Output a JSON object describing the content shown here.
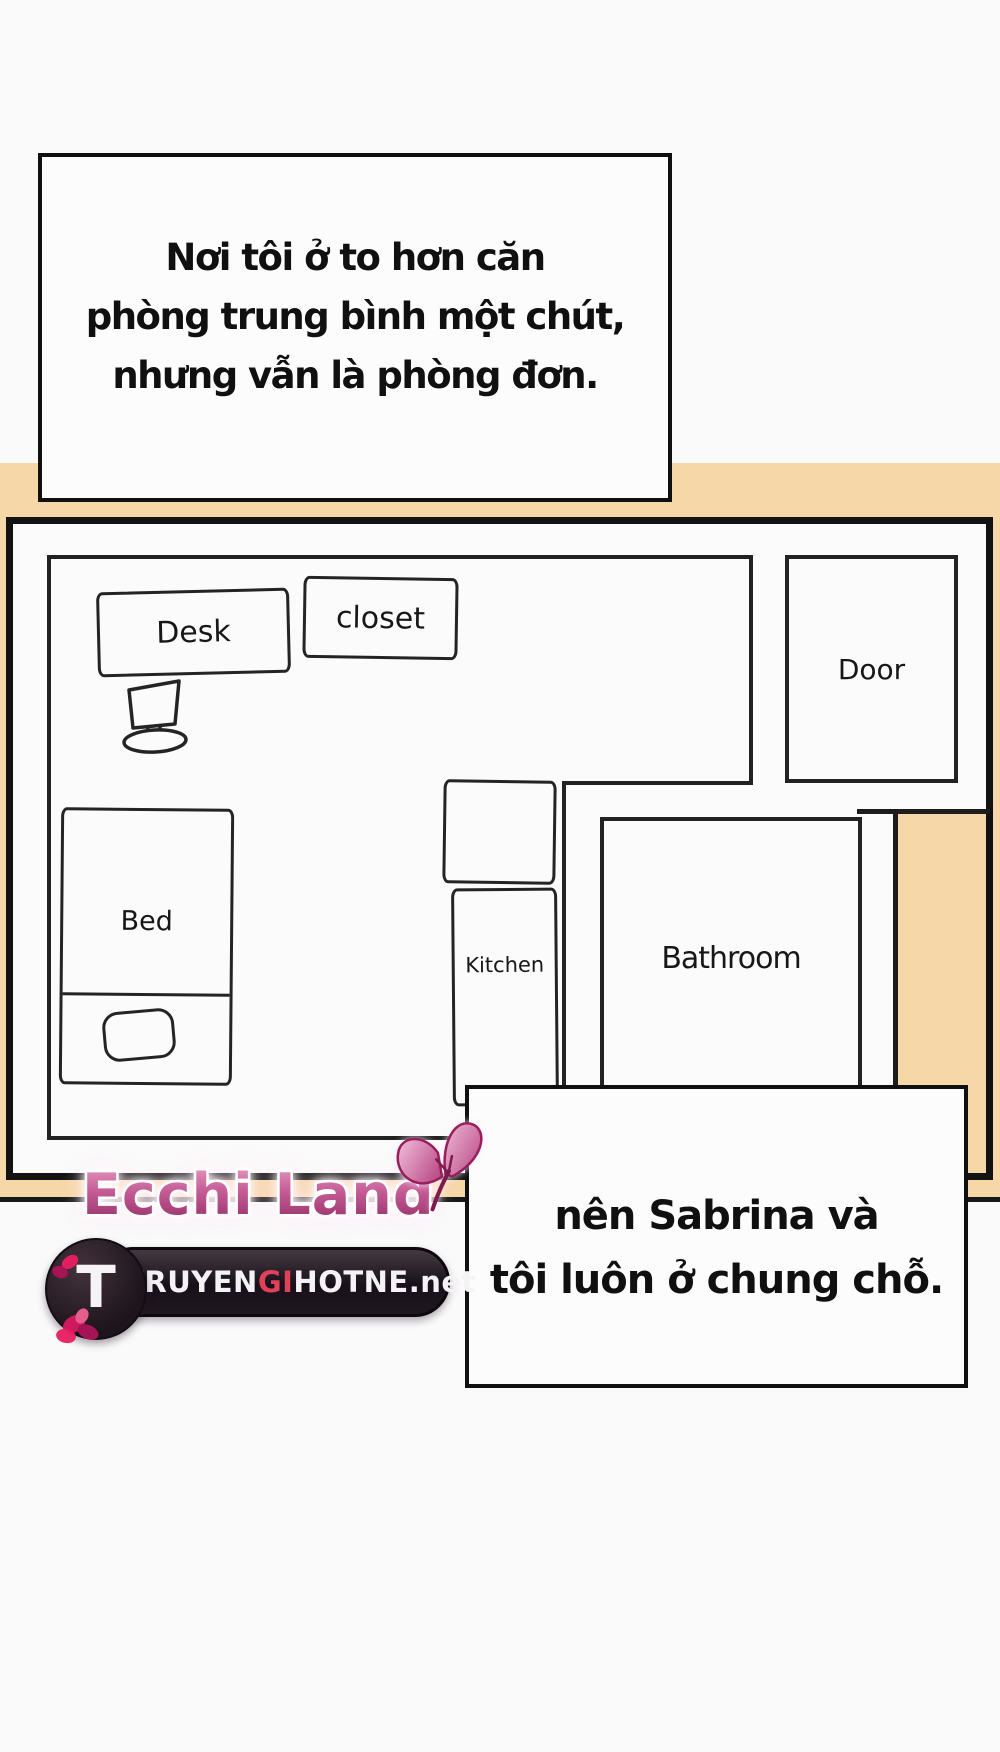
{
  "page": {
    "background_color": "#fafafa",
    "ink_color": "#1a1a1a",
    "peach_color": "#f6d7a7"
  },
  "speech_box_1": {
    "lines": [
      "Nơi tôi ở to hơn căn",
      "phòng trung bình một chút,",
      "nhưng vẫn là phòng đơn."
    ]
  },
  "speech_box_2": {
    "lines": [
      "nên Sabrina và",
      "tôi luôn ở chung chỗ."
    ]
  },
  "floorplan": {
    "desk": {
      "label": "Desk"
    },
    "closet": {
      "label": "closet"
    },
    "door": {
      "label": "Door"
    },
    "bed": {
      "label": "Bed"
    },
    "kitchen": {
      "label": "Kitchen"
    },
    "bathroom": {
      "label": "Bathroom"
    }
  },
  "watermark": {
    "site_name": "Ecchi Land",
    "butterfly_icon": "butterfly",
    "accent_color": "#b53a78",
    "logo": {
      "initial": "T",
      "name_part_1": "TRUYEN",
      "name_part_2": "GI",
      "name_part_3": "HOTNE",
      "name_part_4": ".net",
      "highlight_color": "#e04058",
      "pill_color": "#241c22"
    }
  }
}
